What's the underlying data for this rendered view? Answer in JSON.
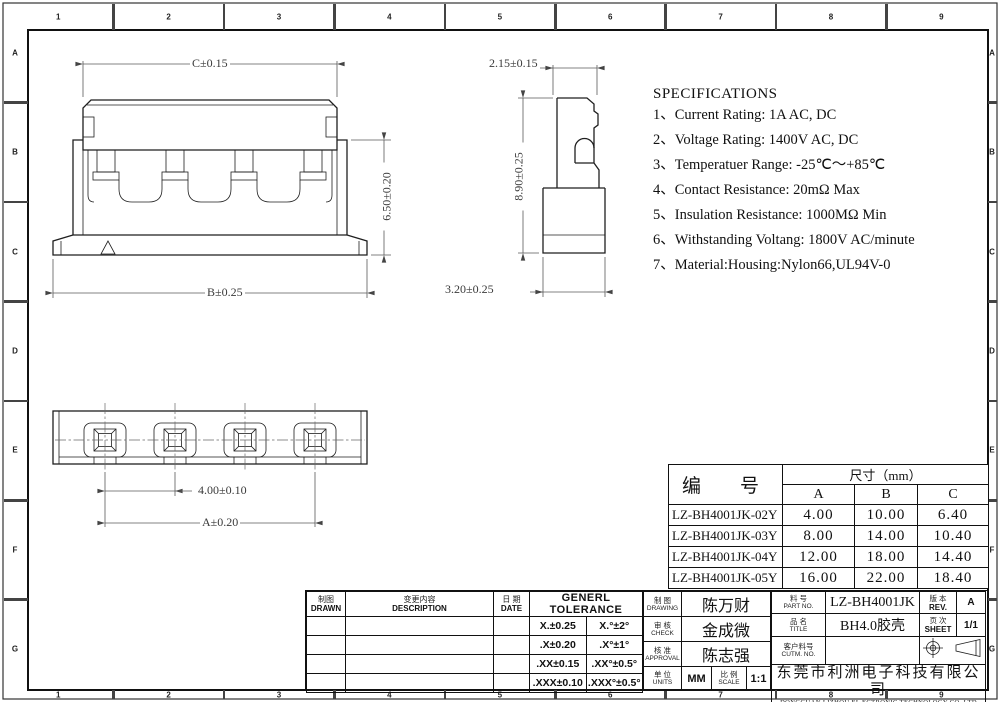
{
  "border": {
    "top": [
      "1",
      "2",
      "3",
      "4",
      "5",
      "6",
      "7",
      "8",
      "9"
    ],
    "bottom": [
      "1",
      "2",
      "3",
      "4",
      "5",
      "6",
      "7",
      "8",
      "9"
    ],
    "left": [
      "A",
      "B",
      "C",
      "D",
      "E",
      "F",
      "G"
    ],
    "right": [
      "A",
      "B",
      "C",
      "D",
      "E",
      "F",
      "G"
    ]
  },
  "views": {
    "front": {
      "dim_width_top": "C±0.15",
      "dim_height": "6.50±0.20",
      "dim_width_bottom": "B±0.25"
    },
    "side": {
      "dim_top": "2.15±0.15",
      "dim_height": "8.90±0.25",
      "dim_bottom": "3.20±0.25"
    },
    "bottom": {
      "dim_pitch": "4.00±0.10",
      "dim_span": "A±0.20"
    }
  },
  "specifications": {
    "title": "SPECIFICATIONS",
    "items": [
      "1、Current Rating: 1A AC, DC",
      "2、Voltage Rating: 1400V AC, DC",
      "3、Temperatuer Range: -25℃～+85℃",
      "4、Contact Resistance: 20mΩ Max",
      "5、Insulation Resistance: 1000MΩ Min",
      "6、Withstanding Voltang: 1800V AC/minute",
      "7、Material:Housing:Nylon66,UL94V-0"
    ]
  },
  "size_table": {
    "col_part": "编　号",
    "col_size": "尺寸（mm）",
    "col_a": "A",
    "col_b": "B",
    "col_c": "C",
    "rows": [
      {
        "part": "LZ-BH4001JK-02Y",
        "a": "4.00",
        "b": "10.00",
        "c": "6.40"
      },
      {
        "part": "LZ-BH4001JK-03Y",
        "a": "8.00",
        "b": "14.00",
        "c": "10.40"
      },
      {
        "part": "LZ-BH4001JK-04Y",
        "a": "12.00",
        "b": "18.00",
        "c": "14.40"
      },
      {
        "part": "LZ-BH4001JK-05Y",
        "a": "16.00",
        "b": "22.00",
        "c": "18.40"
      }
    ]
  },
  "title_block": {
    "drawn_cn": "制图",
    "drawn_en": "DRAWN",
    "description_cn": "变更内容",
    "description_en": "DESCRIPTION",
    "date_cn": "日 期",
    "date_en": "DATE",
    "tolerance_title": "GENERL TOLERANCE",
    "tolerances": [
      [
        "X.±0.25",
        "X.°±2°"
      ],
      [
        ".X±0.20",
        ".X°±1°"
      ],
      [
        ".XX±0.15",
        ".XX°±0.5°"
      ],
      [
        ".XXX±0.10",
        ".XXX°±0.5°"
      ]
    ],
    "drawing_cn": "制 图",
    "drawing_en": "DRAWING",
    "drawing_name": "陈万财",
    "check_cn": "审 核",
    "check_en": "CHECK",
    "check_name": "金成微",
    "approval_cn": "核 准",
    "approval_en": "APPROVAL",
    "approval_name": "陈志强",
    "units_cn": "单 位",
    "units_en": "UNITS",
    "units_value": "MM",
    "scale_cn": "比 例",
    "scale_en": "SCALE",
    "scale_value": "1:1",
    "part_no_cn": "料 号",
    "part_no_en": "PART NO.",
    "part_no": "LZ-BH4001JK",
    "title_cn": "品 名",
    "title_en": "TITLE",
    "product_title": "BH4.0胶壳",
    "customer_cn": "客户料号",
    "customer_en": "CUTM. NO.",
    "customer_value": "",
    "rev_cn": "版 本",
    "rev_en": "REV.",
    "rev": "A",
    "sheet_cn": "页 次",
    "sheet_en": "SHEET",
    "sheet": "1/1"
  },
  "company": {
    "name_cn": "东莞市利洲电子科技有限公司",
    "name_en": "DONGGUAN LIZHOU EL ECTRONIC TECHNOLOGY CO.,LTD"
  }
}
